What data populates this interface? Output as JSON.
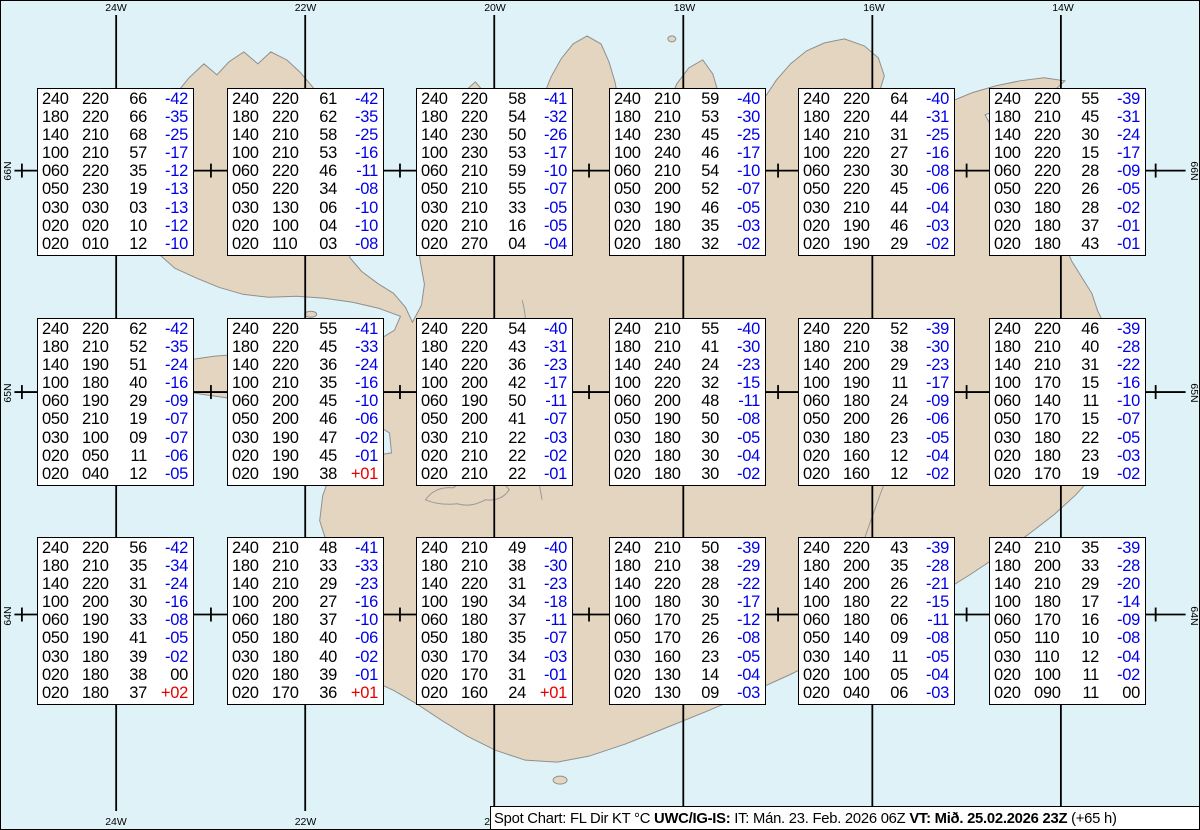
{
  "map": {
    "region": "Iceland",
    "lon_labels": [
      "24W",
      "22W",
      "20W",
      "18W",
      "16W",
      "14W"
    ],
    "lat_labels": [
      "66N",
      "65N",
      "64N"
    ],
    "colors": {
      "water": "#dff2f7",
      "land": "#e3d5bf",
      "coastline": "#8f8f8f",
      "graticule": "#000000",
      "temp_negative": "#0000e8",
      "temp_positive": "#e80000",
      "temp_zero": "#000000"
    }
  },
  "columns": [
    "FL",
    "Dir",
    "KT",
    "°C"
  ],
  "boxes": [
    {
      "rows": [
        [
          "240",
          "220",
          "66",
          "-42"
        ],
        [
          "180",
          "220",
          "66",
          "-35"
        ],
        [
          "140",
          "210",
          "68",
          "-25"
        ],
        [
          "100",
          "210",
          "57",
          "-17"
        ],
        [
          "060",
          "220",
          "35",
          "-12"
        ],
        [
          "050",
          "230",
          "19",
          "-13"
        ],
        [
          "030",
          "030",
          "03",
          "-13"
        ],
        [
          "020",
          "020",
          "10",
          "-12"
        ],
        [
          "020",
          "010",
          "12",
          "-10"
        ]
      ]
    },
    {
      "rows": [
        [
          "240",
          "220",
          "61",
          "-42"
        ],
        [
          "180",
          "220",
          "62",
          "-35"
        ],
        [
          "140",
          "210",
          "58",
          "-25"
        ],
        [
          "100",
          "210",
          "53",
          "-16"
        ],
        [
          "060",
          "220",
          "46",
          "-11"
        ],
        [
          "050",
          "220",
          "34",
          "-08"
        ],
        [
          "030",
          "130",
          "06",
          "-10"
        ],
        [
          "020",
          "100",
          "04",
          "-10"
        ],
        [
          "020",
          "110",
          "03",
          "-08"
        ]
      ]
    },
    {
      "rows": [
        [
          "240",
          "220",
          "58",
          "-41"
        ],
        [
          "180",
          "220",
          "54",
          "-32"
        ],
        [
          "140",
          "230",
          "50",
          "-26"
        ],
        [
          "100",
          "230",
          "53",
          "-17"
        ],
        [
          "060",
          "210",
          "59",
          "-10"
        ],
        [
          "050",
          "210",
          "55",
          "-07"
        ],
        [
          "030",
          "210",
          "33",
          "-05"
        ],
        [
          "020",
          "210",
          "16",
          "-05"
        ],
        [
          "020",
          "270",
          "04",
          "-04"
        ]
      ]
    },
    {
      "rows": [
        [
          "240",
          "210",
          "59",
          "-40"
        ],
        [
          "180",
          "210",
          "53",
          "-30"
        ],
        [
          "140",
          "230",
          "45",
          "-25"
        ],
        [
          "100",
          "240",
          "46",
          "-17"
        ],
        [
          "060",
          "210",
          "54",
          "-10"
        ],
        [
          "050",
          "200",
          "52",
          "-07"
        ],
        [
          "030",
          "190",
          "46",
          "-05"
        ],
        [
          "020",
          "180",
          "35",
          "-03"
        ],
        [
          "020",
          "180",
          "32",
          "-02"
        ]
      ]
    },
    {
      "rows": [
        [
          "240",
          "220",
          "64",
          "-40"
        ],
        [
          "180",
          "220",
          "44",
          "-31"
        ],
        [
          "140",
          "210",
          "31",
          "-25"
        ],
        [
          "100",
          "220",
          "27",
          "-16"
        ],
        [
          "060",
          "230",
          "30",
          "-08"
        ],
        [
          "050",
          "220",
          "45",
          "-06"
        ],
        [
          "030",
          "210",
          "44",
          "-04"
        ],
        [
          "020",
          "190",
          "46",
          "-03"
        ],
        [
          "020",
          "190",
          "29",
          "-02"
        ]
      ]
    },
    {
      "rows": [
        [
          "240",
          "220",
          "55",
          "-39"
        ],
        [
          "180",
          "210",
          "45",
          "-31"
        ],
        [
          "140",
          "220",
          "30",
          "-24"
        ],
        [
          "100",
          "220",
          "15",
          "-17"
        ],
        [
          "060",
          "220",
          "28",
          "-09"
        ],
        [
          "050",
          "220",
          "26",
          "-05"
        ],
        [
          "030",
          "180",
          "28",
          "-02"
        ],
        [
          "020",
          "180",
          "37",
          "-01"
        ],
        [
          "020",
          "180",
          "43",
          "-01"
        ]
      ]
    },
    {
      "rows": [
        [
          "240",
          "220",
          "62",
          "-42"
        ],
        [
          "180",
          "210",
          "52",
          "-35"
        ],
        [
          "140",
          "190",
          "51",
          "-24"
        ],
        [
          "100",
          "180",
          "40",
          "-16"
        ],
        [
          "060",
          "190",
          "29",
          "-09"
        ],
        [
          "050",
          "210",
          "19",
          "-07"
        ],
        [
          "030",
          "100",
          "09",
          "-07"
        ],
        [
          "020",
          "050",
          "11",
          "-06"
        ],
        [
          "020",
          "040",
          "12",
          "-05"
        ]
      ]
    },
    {
      "rows": [
        [
          "240",
          "220",
          "55",
          "-41"
        ],
        [
          "180",
          "220",
          "45",
          "-33"
        ],
        [
          "140",
          "220",
          "36",
          "-24"
        ],
        [
          "100",
          "210",
          "35",
          "-16"
        ],
        [
          "060",
          "200",
          "45",
          "-10"
        ],
        [
          "050",
          "200",
          "46",
          "-06"
        ],
        [
          "030",
          "190",
          "47",
          "-02"
        ],
        [
          "020",
          "190",
          "45",
          "-01"
        ],
        [
          "020",
          "190",
          "38",
          "+01"
        ]
      ]
    },
    {
      "rows": [
        [
          "240",
          "220",
          "54",
          "-40"
        ],
        [
          "180",
          "220",
          "43",
          "-31"
        ],
        [
          "140",
          "220",
          "36",
          "-23"
        ],
        [
          "100",
          "200",
          "42",
          "-17"
        ],
        [
          "060",
          "190",
          "50",
          "-11"
        ],
        [
          "050",
          "200",
          "41",
          "-07"
        ],
        [
          "030",
          "210",
          "22",
          "-03"
        ],
        [
          "020",
          "210",
          "22",
          "-02"
        ],
        [
          "020",
          "210",
          "22",
          "-01"
        ]
      ]
    },
    {
      "rows": [
        [
          "240",
          "210",
          "55",
          "-40"
        ],
        [
          "180",
          "210",
          "41",
          "-30"
        ],
        [
          "140",
          "240",
          "24",
          "-23"
        ],
        [
          "100",
          "220",
          "32",
          "-15"
        ],
        [
          "060",
          "200",
          "48",
          "-11"
        ],
        [
          "050",
          "190",
          "50",
          "-08"
        ],
        [
          "030",
          "180",
          "30",
          "-05"
        ],
        [
          "020",
          "180",
          "30",
          "-04"
        ],
        [
          "020",
          "180",
          "30",
          "-02"
        ]
      ]
    },
    {
      "rows": [
        [
          "240",
          "220",
          "52",
          "-39"
        ],
        [
          "180",
          "210",
          "38",
          "-30"
        ],
        [
          "140",
          "200",
          "29",
          "-23"
        ],
        [
          "100",
          "190",
          "11",
          "-17"
        ],
        [
          "060",
          "180",
          "24",
          "-09"
        ],
        [
          "050",
          "200",
          "26",
          "-06"
        ],
        [
          "030",
          "180",
          "23",
          "-05"
        ],
        [
          "020",
          "160",
          "12",
          "-04"
        ],
        [
          "020",
          "160",
          "12",
          "-02"
        ]
      ]
    },
    {
      "rows": [
        [
          "240",
          "220",
          "46",
          "-39"
        ],
        [
          "180",
          "210",
          "40",
          "-28"
        ],
        [
          "140",
          "210",
          "31",
          "-22"
        ],
        [
          "100",
          "170",
          "15",
          "-16"
        ],
        [
          "060",
          "140",
          "11",
          "-10"
        ],
        [
          "050",
          "170",
          "15",
          "-07"
        ],
        [
          "030",
          "180",
          "22",
          "-05"
        ],
        [
          "020",
          "180",
          "23",
          "-03"
        ],
        [
          "020",
          "170",
          "19",
          "-02"
        ]
      ]
    },
    {
      "rows": [
        [
          "240",
          "220",
          "56",
          "-42"
        ],
        [
          "180",
          "210",
          "35",
          "-34"
        ],
        [
          "140",
          "220",
          "31",
          "-24"
        ],
        [
          "100",
          "200",
          "30",
          "-16"
        ],
        [
          "060",
          "190",
          "33",
          "-08"
        ],
        [
          "050",
          "190",
          "41",
          "-05"
        ],
        [
          "030",
          "180",
          "39",
          "-02"
        ],
        [
          "020",
          "180",
          "38",
          "00"
        ],
        [
          "020",
          "180",
          "37",
          "+02"
        ]
      ]
    },
    {
      "rows": [
        [
          "240",
          "210",
          "48",
          "-41"
        ],
        [
          "180",
          "210",
          "33",
          "-33"
        ],
        [
          "140",
          "210",
          "29",
          "-23"
        ],
        [
          "100",
          "200",
          "27",
          "-16"
        ],
        [
          "060",
          "180",
          "37",
          "-10"
        ],
        [
          "050",
          "180",
          "40",
          "-06"
        ],
        [
          "030",
          "180",
          "40",
          "-02"
        ],
        [
          "020",
          "180",
          "39",
          "-01"
        ],
        [
          "020",
          "170",
          "36",
          "+01"
        ]
      ]
    },
    {
      "rows": [
        [
          "240",
          "210",
          "49",
          "-40"
        ],
        [
          "180",
          "210",
          "38",
          "-30"
        ],
        [
          "140",
          "220",
          "31",
          "-23"
        ],
        [
          "100",
          "190",
          "34",
          "-18"
        ],
        [
          "060",
          "180",
          "37",
          "-11"
        ],
        [
          "050",
          "180",
          "35",
          "-07"
        ],
        [
          "030",
          "170",
          "34",
          "-03"
        ],
        [
          "020",
          "170",
          "31",
          "-01"
        ],
        [
          "020",
          "160",
          "24",
          "+01"
        ]
      ]
    },
    {
      "rows": [
        [
          "240",
          "210",
          "50",
          "-39"
        ],
        [
          "180",
          "210",
          "38",
          "-29"
        ],
        [
          "140",
          "220",
          "28",
          "-22"
        ],
        [
          "100",
          "180",
          "30",
          "-17"
        ],
        [
          "060",
          "170",
          "25",
          "-12"
        ],
        [
          "050",
          "170",
          "26",
          "-08"
        ],
        [
          "030",
          "160",
          "23",
          "-05"
        ],
        [
          "020",
          "130",
          "14",
          "-04"
        ],
        [
          "020",
          "130",
          "09",
          "-03"
        ]
      ]
    },
    {
      "rows": [
        [
          "240",
          "220",
          "43",
          "-39"
        ],
        [
          "180",
          "200",
          "35",
          "-28"
        ],
        [
          "140",
          "200",
          "26",
          "-21"
        ],
        [
          "100",
          "180",
          "22",
          "-15"
        ],
        [
          "060",
          "180",
          "06",
          "-11"
        ],
        [
          "050",
          "140",
          "09",
          "-08"
        ],
        [
          "030",
          "140",
          "11",
          "-05"
        ],
        [
          "020",
          "100",
          "05",
          "-04"
        ],
        [
          "020",
          "040",
          "06",
          "-03"
        ]
      ]
    },
    {
      "rows": [
        [
          "240",
          "210",
          "35",
          "-39"
        ],
        [
          "180",
          "200",
          "33",
          "-28"
        ],
        [
          "140",
          "210",
          "29",
          "-20"
        ],
        [
          "100",
          "180",
          "17",
          "-14"
        ],
        [
          "060",
          "170",
          "16",
          "-09"
        ],
        [
          "050",
          "110",
          "10",
          "-08"
        ],
        [
          "030",
          "110",
          "12",
          "-04"
        ],
        [
          "020",
          "100",
          "11",
          "-02"
        ],
        [
          "020",
          "090",
          "11",
          "00"
        ]
      ]
    }
  ],
  "status_bar": {
    "segments": [
      {
        "text": "Spot Chart: FL Dir KT °C ",
        "bold": false
      },
      {
        "text": "UWC/IG-IS:",
        "bold": true
      },
      {
        "text": " IT: Mán. 23. Feb. 2026 06Z ",
        "bold": false
      },
      {
        "text": "VT: Mið. 25.02.2026 23Z",
        "bold": true
      },
      {
        "text": " (+65 h)",
        "bold": false
      }
    ]
  }
}
